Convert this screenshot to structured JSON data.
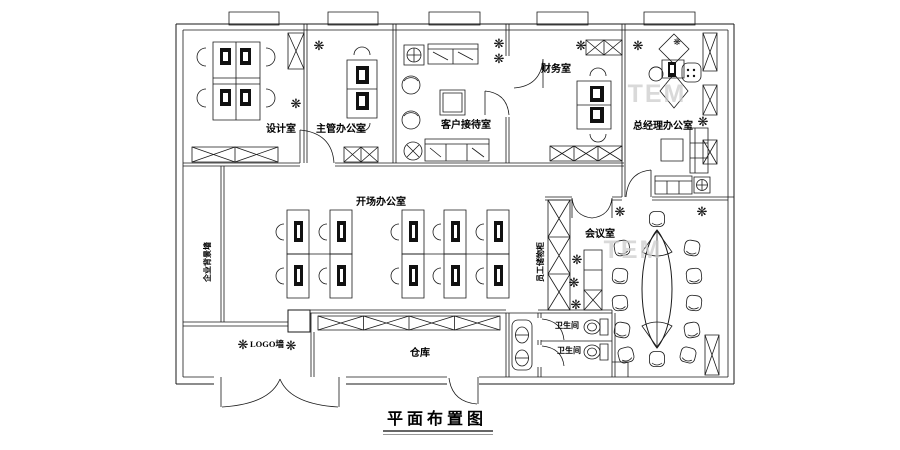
{
  "title": "平面布置图",
  "watermark": "TEM",
  "icons": {
    "plant": "❋"
  },
  "colors": {
    "line": "#1a1a1a",
    "watermark": "#cdcdcd",
    "background": "#ffffff"
  },
  "rooms": {
    "design": "设计室",
    "supervisor": "主管办公室",
    "reception": "客户接待室",
    "finance": "财务室",
    "gm": "总经理办公室",
    "open_office": "开场办公室",
    "meeting": "会议室",
    "warehouse": "仓库",
    "toilet_upper": "卫生间",
    "toilet_lower": "卫生间",
    "logo_wall": "LOGO墙",
    "bg_wall": "企业背景墙",
    "locker": "员工储物柜"
  }
}
